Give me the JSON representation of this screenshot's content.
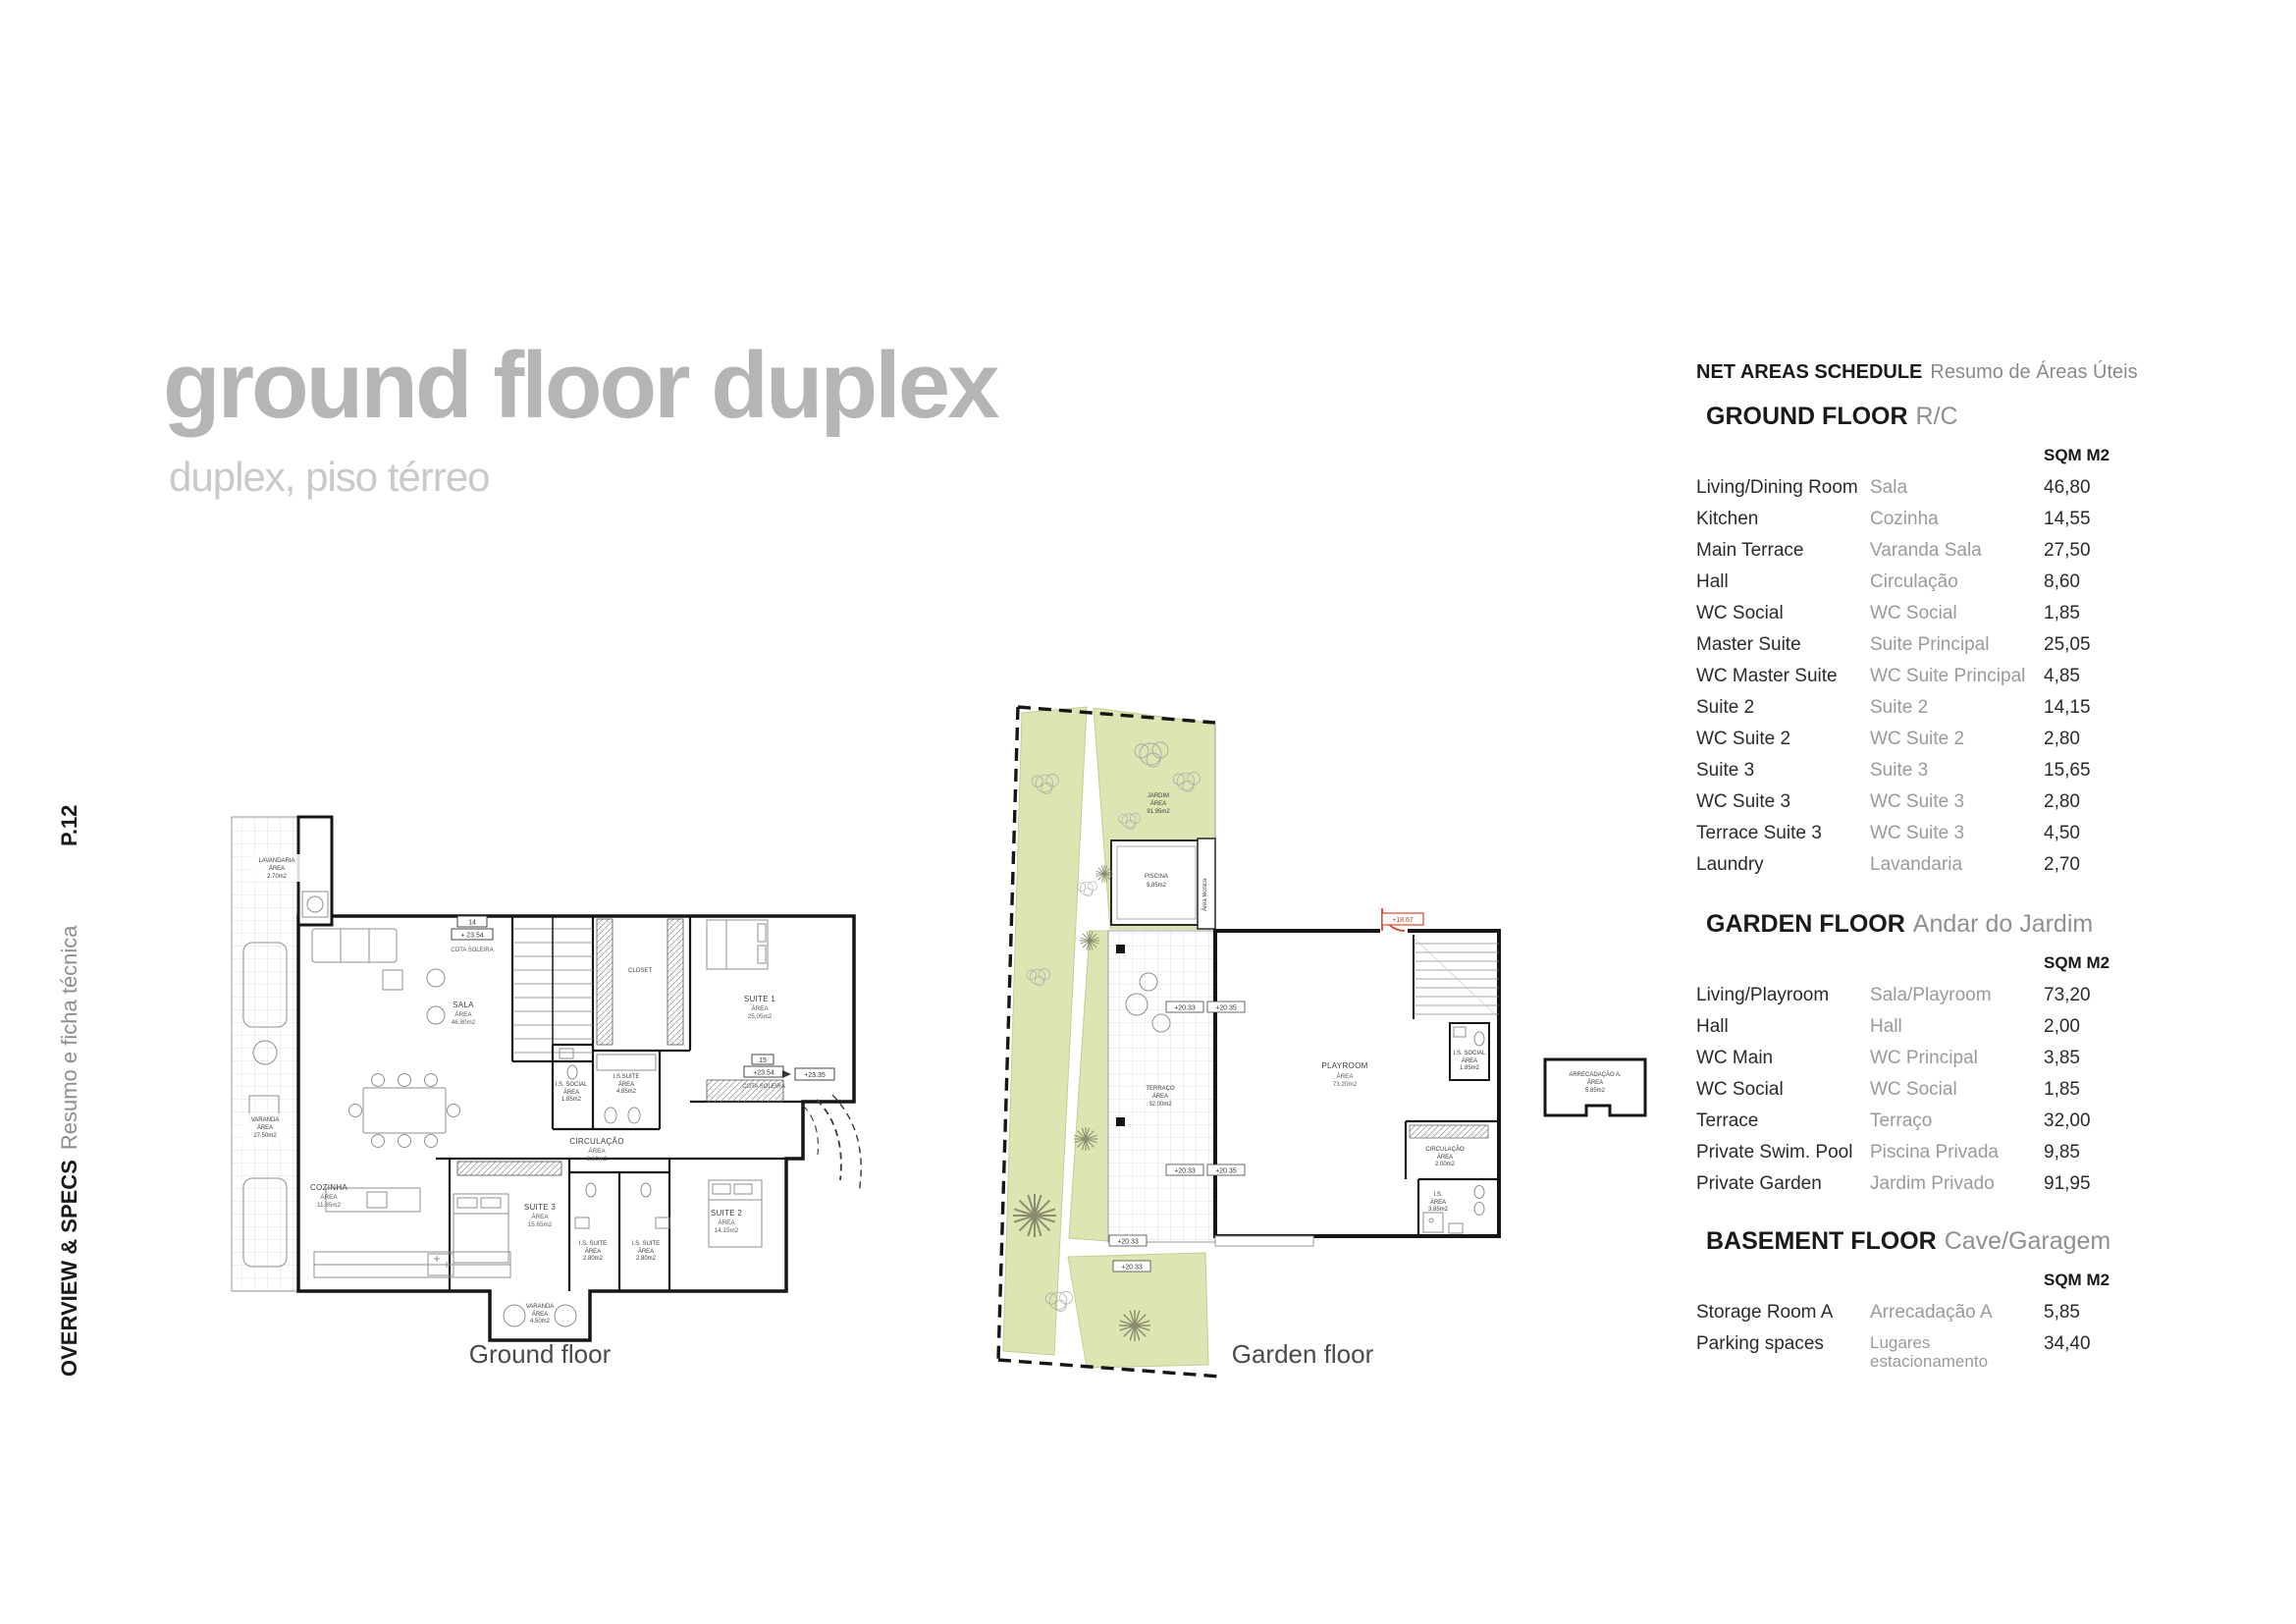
{
  "page": {
    "title": "ground floor duplex",
    "subtitle": "duplex, piso térreo",
    "page_number": "P.12",
    "sidebar_en": "OVERVIEW & SPECS",
    "sidebar_pt": "Resumo e ficha técnica"
  },
  "schedule": {
    "title_en": "NET AREAS SCHEDULE",
    "title_pt": "Resumo de Áreas Úteis",
    "unit_label": "SQM M2",
    "sections": [
      {
        "name_en": "GROUND FLOOR",
        "name_pt": "R/C",
        "rows": [
          {
            "en": "Living/Dining Room",
            "pt": "Sala",
            "sqm": "46,80"
          },
          {
            "en": "Kitchen",
            "pt": "Cozinha",
            "sqm": "14,55"
          },
          {
            "en": "Main Terrace",
            "pt": "Varanda Sala",
            "sqm": "27,50"
          },
          {
            "en": "Hall",
            "pt": "Circulação",
            "sqm": "8,60"
          },
          {
            "en": "WC Social",
            "pt": "WC Social",
            "sqm": "1,85"
          },
          {
            "en": "Master Suite",
            "pt": "Suite Principal",
            "sqm": "25,05"
          },
          {
            "en": "WC Master Suite",
            "pt": "WC Suite Principal",
            "sqm": "4,85"
          },
          {
            "en": "Suite 2",
            "pt": "Suite 2",
            "sqm": "14,15"
          },
          {
            "en": "WC Suite 2",
            "pt": "WC Suite 2",
            "sqm": "2,80"
          },
          {
            "en": "Suite 3",
            "pt": "Suite 3",
            "sqm": "15,65"
          },
          {
            "en": "WC Suite 3",
            "pt": "WC Suite 3",
            "sqm": "2,80"
          },
          {
            "en": "Terrace Suite 3",
            "pt": "WC Suite 3",
            "sqm": "4,50"
          },
          {
            "en": "Laundry",
            "pt": "Lavandaria",
            "sqm": "2,70"
          }
        ]
      },
      {
        "name_en": "GARDEN FLOOR",
        "name_pt": "Andar do Jardim",
        "rows": [
          {
            "en": "Living/Playroom",
            "pt": "Sala/Playroom",
            "sqm": "73,20"
          },
          {
            "en": "Hall",
            "pt": "Hall",
            "sqm": "2,00"
          },
          {
            "en": "WC Main",
            "pt": "WC Principal",
            "sqm": "3,85"
          },
          {
            "en": "WC Social",
            "pt": "WC Social",
            "sqm": "1,85"
          },
          {
            "en": "Terrace",
            "pt": "Terraço",
            "sqm": "32,00"
          },
          {
            "en": "Private Swim. Pool",
            "pt": "Piscina Privada",
            "sqm": "9,85"
          },
          {
            "en": "Private Garden",
            "pt": "Jardim Privado",
            "sqm": "91,95"
          }
        ]
      },
      {
        "name_en": "BASEMENT FLOOR",
        "name_pt": "Cave/Garagem",
        "rows": [
          {
            "en": "Storage Room A",
            "pt": "Arrecadação A",
            "sqm": "5,85"
          },
          {
            "en": "Parking spaces",
            "pt": "Lugares estacionamento",
            "sqm": "34,40"
          }
        ]
      }
    ]
  },
  "plans": {
    "ground": {
      "caption": "Ground floor",
      "rooms": {
        "lavandaria": {
          "n": "LAVANDARIA",
          "a": "ÁREA",
          "v": "2.70m2"
        },
        "sala": {
          "n": "SALA",
          "a": "ÁREA",
          "v": "46.80m2"
        },
        "varanda": {
          "n": "VARANDA",
          "a": "ÁREA",
          "v": "27.50m2"
        },
        "cozinha": {
          "n": "COZINHA",
          "a": "ÁREA",
          "v": "11.85m2"
        },
        "suite3": {
          "n": "SUITE 3",
          "a": "ÁREA",
          "v": "15.65m2"
        },
        "is_suite3a": {
          "n": "I.S. SUITE",
          "a": "ÁREA",
          "v": "2.80m2"
        },
        "is_suite3b": {
          "n": "I.S. SUITE",
          "a": "ÁREA",
          "v": "2.80m2"
        },
        "suite2": {
          "n": "SUITE 2",
          "a": "ÁREA",
          "v": "14.15m2"
        },
        "suite1": {
          "n": "SUITE 1",
          "a": "ÁREA",
          "v": "25.05m2"
        },
        "closet": {
          "n": "CLOSET"
        },
        "is_suite1": {
          "n": "I.S.SUITE",
          "a": "ÁREA",
          "v": "4.85m2"
        },
        "is_social": {
          "n": "I.S. SOCIAL",
          "a": "ÁREA",
          "v": "1.85m2"
        },
        "circulacao": {
          "n": "CIRCULAÇÃO",
          "a": "ÁREA",
          "v": "8.60m2"
        },
        "varanda_sul": {
          "n": "VARANDA",
          "a": "ÁREA",
          "v": "4.50m2"
        }
      },
      "markers": {
        "m14": "14",
        "m14_cota": "+ 23.54",
        "cota": "COTA SOLEIRA",
        "m15": "15",
        "m15_cota": "+23.54",
        "cota2": "COTA SOLEIRA",
        "nivel": "+23.35"
      }
    },
    "garden": {
      "caption": "Garden floor",
      "tech_label": "Área técnica",
      "rooms": {
        "jardim": {
          "n": "JARDIM",
          "a": "ÁREA",
          "v": "91.95m2"
        },
        "piscina": {
          "n": "PISCINA",
          "v": "9,85m2"
        },
        "terraco": {
          "n": "TERRAÇO",
          "a": "ÁREA",
          "v": "32.00m2"
        },
        "playroom": {
          "n": "PLAYROOM",
          "a": "ÁREA",
          "v": "73.20m2"
        },
        "is_social": {
          "n": "I.S. SOCIAL",
          "a": "ÁREA",
          "v": "1.85m2"
        },
        "circulacao": {
          "n": "CIRCULAÇÃO",
          "a": "ÁREA",
          "v": "2.00m2"
        },
        "is": {
          "n": "I.S.",
          "a": "ÁREA",
          "v": "3.85m2"
        },
        "arrecadacao": {
          "n": "ARRECADAÇÃO A.",
          "a": "ÁREA",
          "v": "5.85m2"
        }
      },
      "markers": {
        "p1": "+20.33",
        "p2": "+20.35",
        "p3": "+20.33",
        "p4": "+20.35",
        "p5": "+20.33",
        "p6": "+20.33",
        "entry": "+18.67"
      }
    }
  }
}
